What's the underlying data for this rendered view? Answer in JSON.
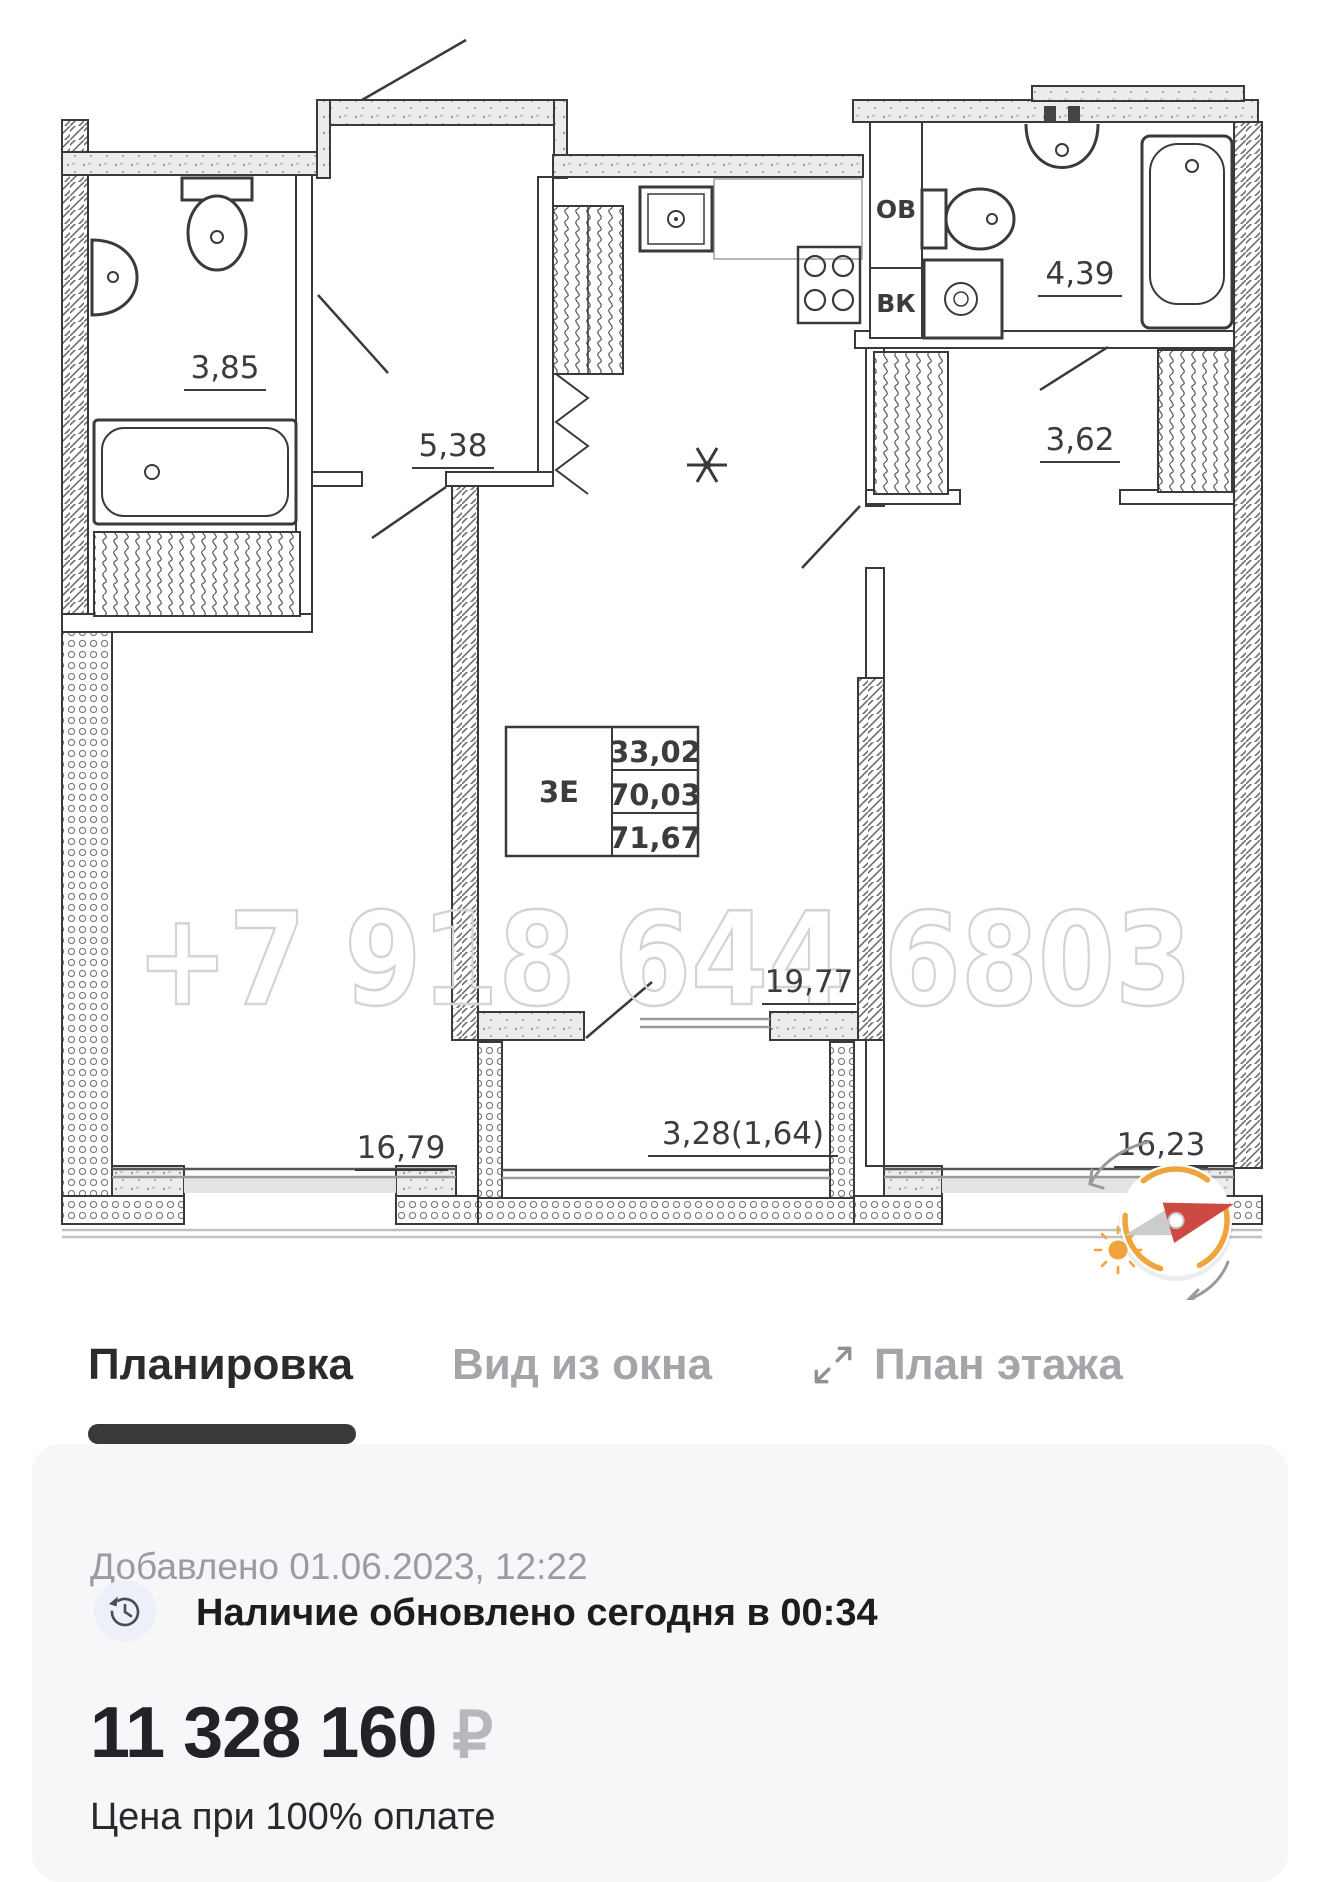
{
  "plan": {
    "watermark": "+7 918 644 6803",
    "spec_table": {
      "type": "3Е",
      "values": [
        "33,02",
        "70,03",
        "71,67"
      ]
    },
    "labels": {
      "bathroom_small": "3,85",
      "hallway": "5,38",
      "bathroom_large": "4,39",
      "wardrobe": "3,62",
      "room_left": "16,79",
      "kitchen_living": "19,77",
      "balcony": "3,28(1,64)",
      "room_right": "16,23",
      "shaft_ov": "ОВ",
      "shaft_vk": "ВК"
    }
  },
  "tabs": {
    "layout": "Планировка",
    "window_view": "Вид из окна",
    "floor_plan": "План этажа"
  },
  "info": {
    "added": "Добавлено 01.06.2023, 12:22",
    "availability": "Наличие обновлено сегодня в 00:34",
    "price": "11 328 160",
    "currency": "₽",
    "price_note": "Цена при 100% оплате"
  },
  "colors": {
    "accent": "#F0A43C",
    "needle": "#CD4A43",
    "tab_active": "#2B2B2E",
    "tab_inactive": "#A4A4A9",
    "currency": "#B7B7BC"
  }
}
